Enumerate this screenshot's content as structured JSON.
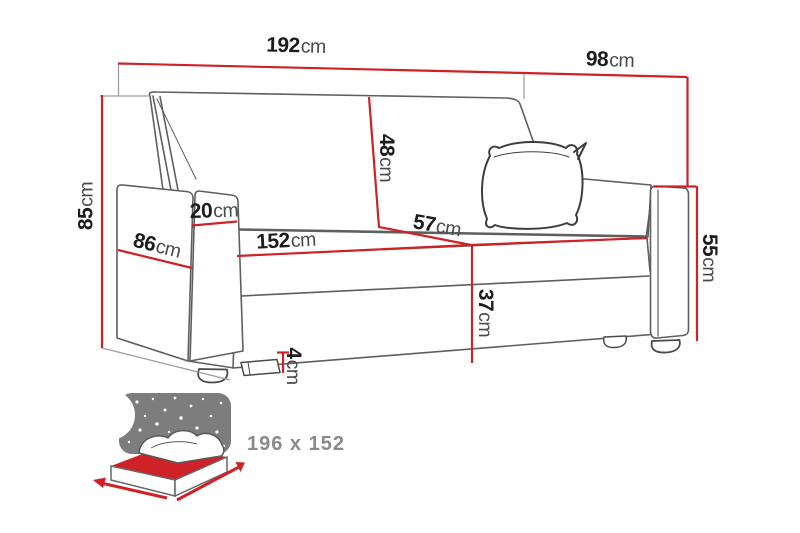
{
  "diagram": {
    "type": "sofa-dimensions-drawing",
    "dimensions": [
      {
        "id": "overall-width",
        "value": "192",
        "unit": "cm"
      },
      {
        "id": "overall-depth",
        "value": "98",
        "unit": "cm"
      },
      {
        "id": "overall-height",
        "value": "85",
        "unit": "cm"
      },
      {
        "id": "armrest-top-width",
        "value": "20",
        "unit": "cm"
      },
      {
        "id": "side-depth",
        "value": "86",
        "unit": "cm"
      },
      {
        "id": "seat-width",
        "value": "152",
        "unit": "cm"
      },
      {
        "id": "backrest-height",
        "value": "48",
        "unit": "cm"
      },
      {
        "id": "seat-depth",
        "value": "57",
        "unit": "cm"
      },
      {
        "id": "seat-height",
        "value": "37",
        "unit": "cm"
      },
      {
        "id": "armrest-height",
        "value": "55",
        "unit": "cm"
      },
      {
        "id": "leg-height",
        "value": "4",
        "unit": "cm"
      }
    ],
    "sleeping_area": {
      "label": "196 x 152"
    },
    "colors": {
      "dimension_line": "#cf2128",
      "sketch_line": "#5f5f5f",
      "number_text": "#1c1c1c",
      "unit_text": "#4a4a4a",
      "sleeping_text": "#8a8a8a",
      "icon_sky": "#7d7d7d"
    }
  }
}
